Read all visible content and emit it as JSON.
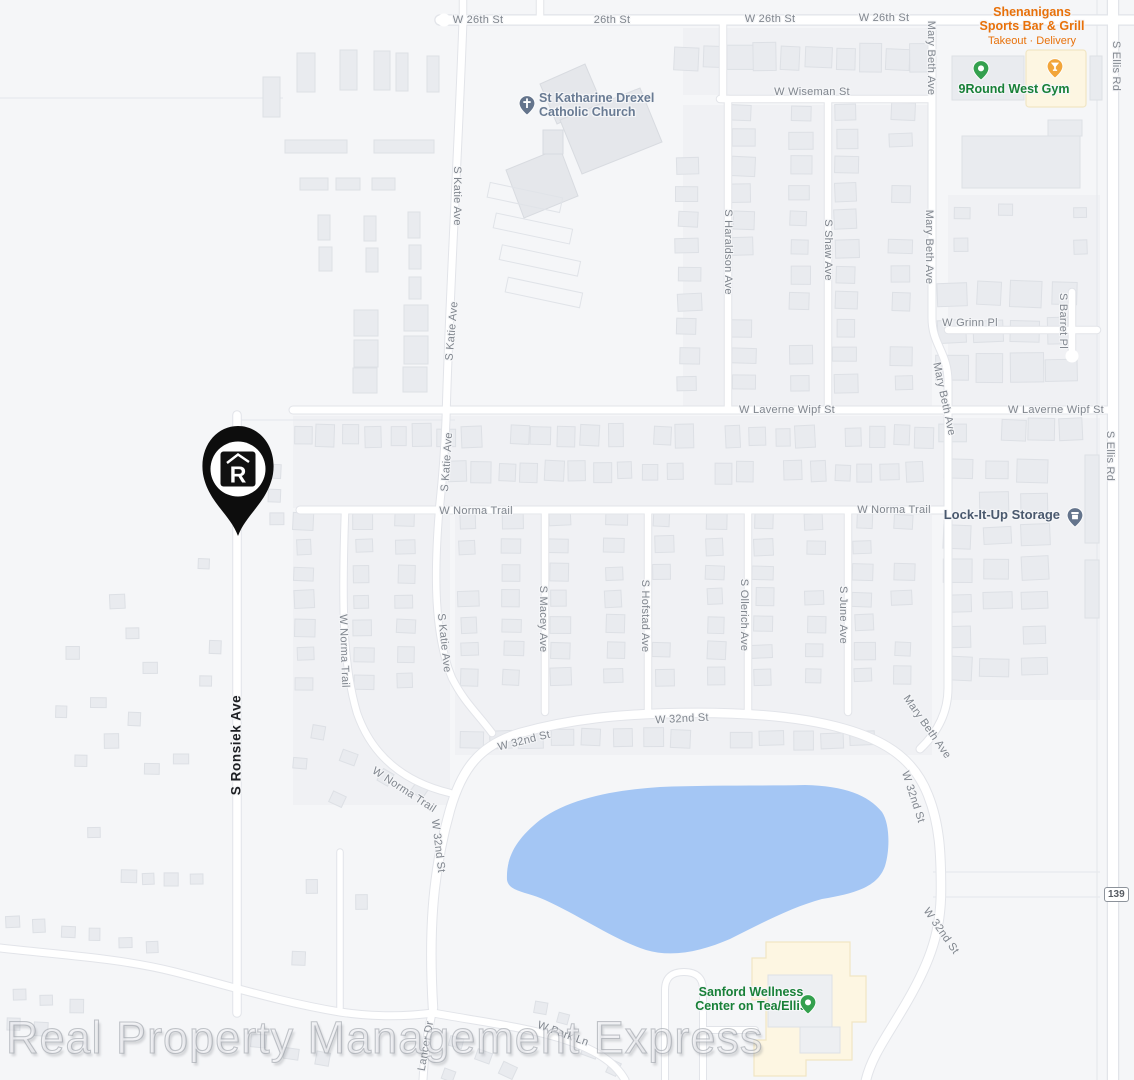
{
  "map_title": "Neighborhood road map",
  "watermark_text": "Real Property Management Express",
  "route_badge": "139",
  "colors": {
    "water": "#a4c6f4",
    "land": "#f5f6f8",
    "block": "#f0f1f4",
    "building": "#e9ebef",
    "road_fill": "#ffffff",
    "road_casing": "#e2e4e9",
    "street_label": "#80868e",
    "highlight_street_label": "#1c1e22",
    "poi_orange": "#e8710a",
    "poi_green": "#188038",
    "poi_slate": "#697b93",
    "marker_black": "#0d0d0d",
    "poi_area_beige": "#fdf6e2"
  },
  "pois": {
    "shenanigans": {
      "lines": [
        "Shenanigans",
        "Sports Bar & Grill"
      ],
      "sub": "Takeout · Delivery",
      "color": "#e8710a",
      "pin_color": "#f2a53a"
    },
    "nineround": {
      "label": "9Round West Gym",
      "color": "#188038",
      "pin_color": "#34a04e"
    },
    "church": {
      "lines": [
        "St Katharine Drexel",
        "Catholic Church"
      ],
      "color": "#697b93",
      "pin_color": "#64748c"
    },
    "storage": {
      "label": "Lock-It-Up Storage",
      "color": "#4a596e",
      "pin_color": "#64748c"
    },
    "wellness": {
      "lines": [
        "Sanford Wellness",
        "Center on Tea/Ellis"
      ],
      "color": "#188038",
      "pin_color": "#34a04e"
    }
  },
  "property_marker": {
    "logo_letter": "R"
  },
  "street_labels": [
    {
      "t": "W 26th St",
      "x": 478,
      "y": 20,
      "r": 0
    },
    {
      "t": "26th St",
      "x": 612,
      "y": 20,
      "r": 0
    },
    {
      "t": "W 26th St",
      "x": 770,
      "y": 19,
      "r": 0
    },
    {
      "t": "W 26th St",
      "x": 884,
      "y": 18,
      "r": 0
    },
    {
      "t": "S Ellis Rd",
      "x": 1116,
      "y": 66,
      "r": 90
    },
    {
      "t": "Mary Beth Ave",
      "x": 931,
      "y": 58,
      "r": 90
    },
    {
      "t": "W Wiseman St",
      "x": 812,
      "y": 92,
      "r": 0
    },
    {
      "t": "S Katie Ave",
      "x": 457,
      "y": 196,
      "r": 90
    },
    {
      "t": "S Katie Ave",
      "x": 452,
      "y": 331,
      "r": -85
    },
    {
      "t": "S Katie Ave",
      "x": 447,
      "y": 462,
      "r": -86
    },
    {
      "t": "S Haraldson Ave",
      "x": 728,
      "y": 252,
      "r": 90
    },
    {
      "t": "S Shaw Ave",
      "x": 828,
      "y": 250,
      "r": 90
    },
    {
      "t": "Mary Beth Ave",
      "x": 929,
      "y": 247,
      "r": 90
    },
    {
      "t": "W Grinn Pl",
      "x": 970,
      "y": 323,
      "r": 0
    },
    {
      "t": "S Barret Pl",
      "x": 1063,
      "y": 321,
      "r": 90
    },
    {
      "t": "Mary Beth Ave",
      "x": 944,
      "y": 399,
      "r": 78
    },
    {
      "t": "W Laverne Wipf St",
      "x": 787,
      "y": 410,
      "r": 0
    },
    {
      "t": "W Laverne Wipf St",
      "x": 1056,
      "y": 410,
      "r": 0
    },
    {
      "t": "S Ellis Rd",
      "x": 1110,
      "y": 456,
      "r": 90
    },
    {
      "t": "W Norma Trail",
      "x": 476,
      "y": 511,
      "r": 0
    },
    {
      "t": "W Norma Trail",
      "x": 894,
      "y": 510,
      "r": 0
    },
    {
      "t": "W Norma Trail",
      "x": 344,
      "y": 651,
      "r": 88
    },
    {
      "t": "S Katie Ave",
      "x": 444,
      "y": 643,
      "r": 84
    },
    {
      "t": "S Macey Ave",
      "x": 543,
      "y": 619,
      "r": 90
    },
    {
      "t": "S Hofstad Ave",
      "x": 645,
      "y": 616,
      "r": 90
    },
    {
      "t": "S Ollerich Ave",
      "x": 744,
      "y": 615,
      "r": 90
    },
    {
      "t": "S June Ave",
      "x": 843,
      "y": 615,
      "r": 90
    },
    {
      "t": "S Ronsiek Ave",
      "x": 236,
      "y": 745,
      "r": -90,
      "hl": true
    },
    {
      "t": "W 32nd St",
      "x": 682,
      "y": 719,
      "r": -3
    },
    {
      "t": "W 32nd St",
      "x": 524,
      "y": 741,
      "r": -14
    },
    {
      "t": "Mary Beth Ave",
      "x": 927,
      "y": 727,
      "r": 55
    },
    {
      "t": "W Norma Trail",
      "x": 404,
      "y": 790,
      "r": 33
    },
    {
      "t": "W 32nd St",
      "x": 438,
      "y": 846,
      "r": 83
    },
    {
      "t": "W 32nd St",
      "x": 913,
      "y": 797,
      "r": 72
    },
    {
      "t": "W 32nd St",
      "x": 941,
      "y": 931,
      "r": 55
    },
    {
      "t": "W Park Ln",
      "x": 563,
      "y": 1034,
      "r": 20
    },
    {
      "t": "Lancer Dr",
      "x": 426,
      "y": 1046,
      "r": -80
    }
  ]
}
